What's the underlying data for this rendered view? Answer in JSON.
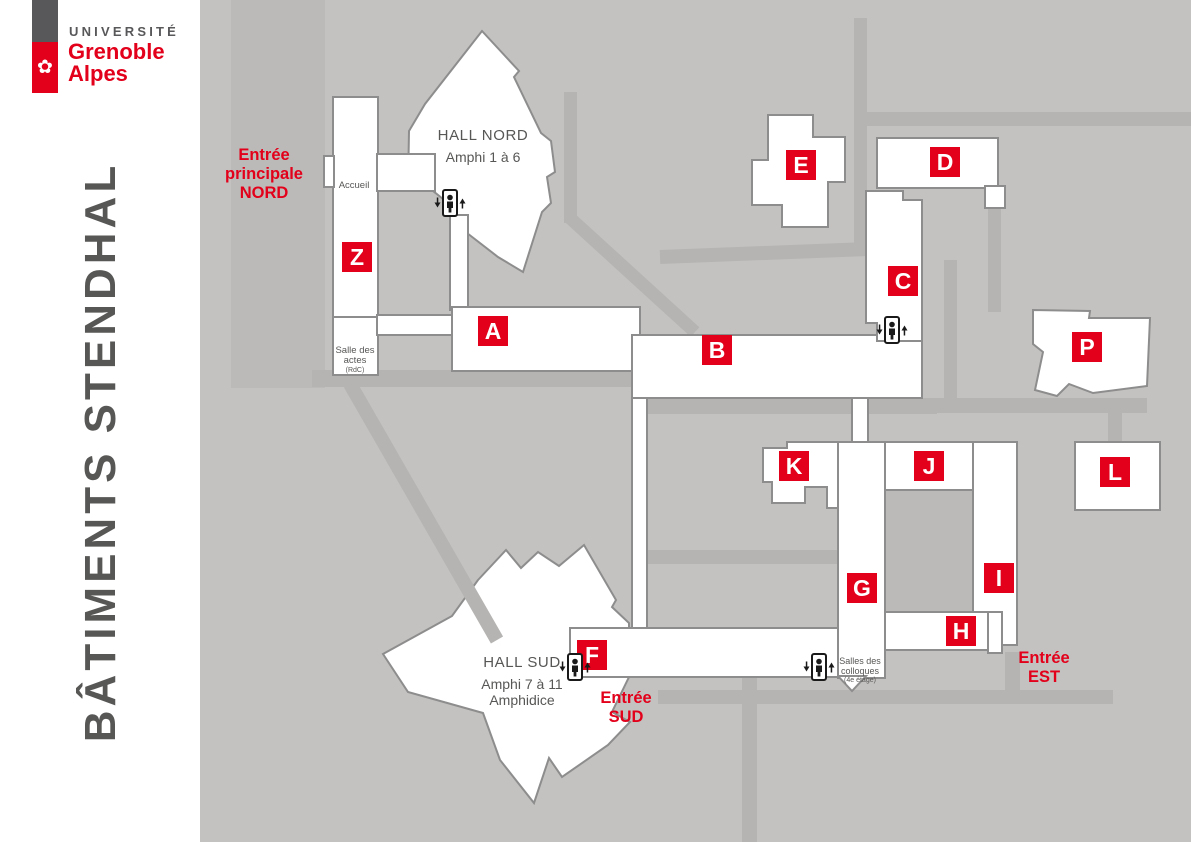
{
  "brand": {
    "university_label": "UNIVERSITÉ",
    "name_line1": "Grenoble",
    "name_line2": "Alpes",
    "flower_icon": "✿",
    "colors": {
      "red": "#e2001a",
      "gray": "#58585a"
    }
  },
  "page_title": "BÂTIMENTS STENDHAL",
  "map": {
    "colors": {
      "background": "#c4c2c0",
      "walkway": "#b6b4b2",
      "building_fill": "#ffffff",
      "building_border": "#8d8d8d",
      "badge_red": "#e2001a",
      "label_gray": "#575756"
    },
    "halls": [
      {
        "name": "HALL NORD",
        "subtitle": "Amphi 1 à 6"
      },
      {
        "name": "HALL SUD",
        "subtitle": "Amphi 7 à 11\nAmphidice"
      }
    ],
    "entrances": [
      {
        "label": "Entrée\nprincipale\nNORD"
      },
      {
        "label": "Entrée\nSUD"
      },
      {
        "label": "Entrée\nEST"
      }
    ],
    "rooms": [
      {
        "label": "Accueil"
      },
      {
        "label": "Salle des\nactes",
        "note": "(RdC)"
      },
      {
        "label": "Salles des\ncolloques",
        "note": "(4e étage)"
      }
    ],
    "buildings": [
      {
        "letter": "Z"
      },
      {
        "letter": "A"
      },
      {
        "letter": "B"
      },
      {
        "letter": "C"
      },
      {
        "letter": "D"
      },
      {
        "letter": "E"
      },
      {
        "letter": "F"
      },
      {
        "letter": "G"
      },
      {
        "letter": "H"
      },
      {
        "letter": "I"
      },
      {
        "letter": "J"
      },
      {
        "letter": "K"
      },
      {
        "letter": "L"
      },
      {
        "letter": "P"
      }
    ],
    "elevators_count": "4"
  }
}
